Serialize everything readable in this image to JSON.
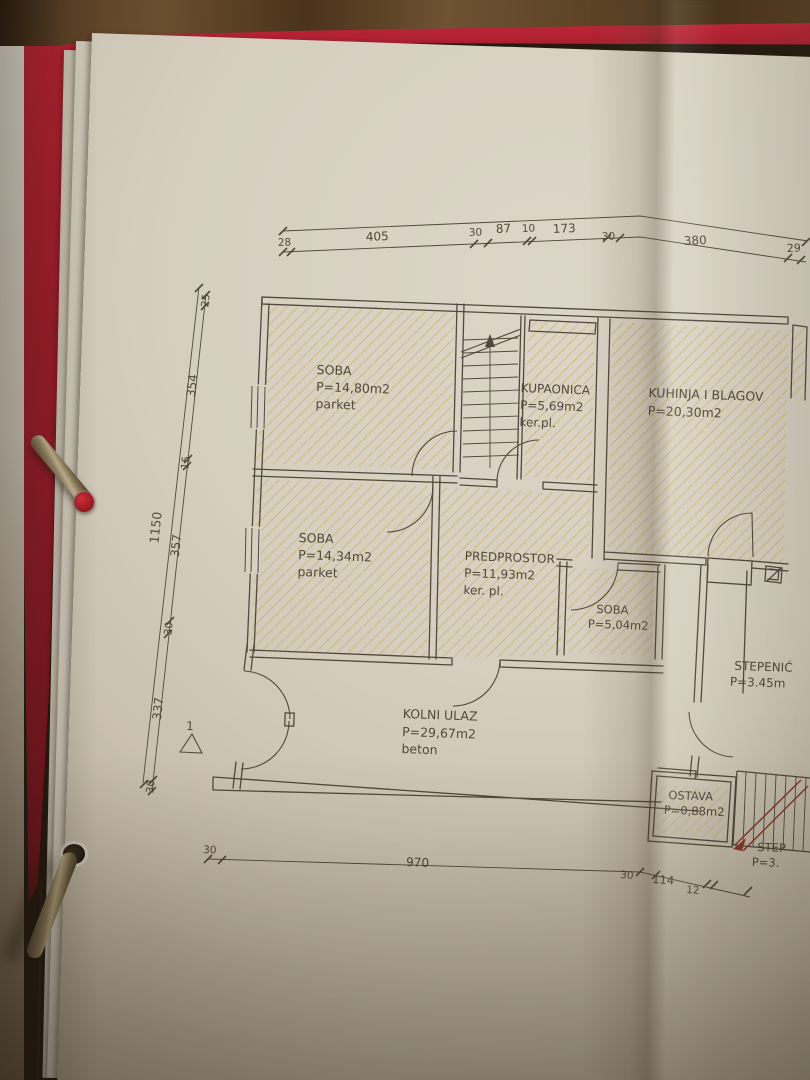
{
  "photo": {
    "surface": "wood-table",
    "binder_color": "#a91f2b",
    "paper_color": "#d6cfc0",
    "ink_color": "#4c4437",
    "hatch_color": "#bfab44",
    "stair_section_color": "#8a3a2c"
  },
  "plan": {
    "rooms": [
      {
        "name": "SOBA",
        "area": "P=14,80m2",
        "floor": "parket"
      },
      {
        "name": "KUPAONICA",
        "area": "P=5,69m2",
        "floor": "ker.pl."
      },
      {
        "name": "KUHINJA I BLAGOV",
        "area": "P=20,30m2",
        "floor": ""
      },
      {
        "name": "SOBA",
        "area": "P=14,34m2",
        "floor": "parket"
      },
      {
        "name": "PREDPROSTOR",
        "area": "P=11,93m2",
        "floor": "ker. pl."
      },
      {
        "name": "SOBA",
        "area": "P=5,04m2",
        "floor": ""
      },
      {
        "name": "STEPENIĆ",
        "area": "P=3.45m",
        "floor": ""
      },
      {
        "name": "KOLNI ULAZ",
        "area": "P=29,67m2",
        "floor": "beton"
      },
      {
        "name": "OSTAVA",
        "area": "P=0,88m2",
        "floor": ""
      },
      {
        "name": "STEP",
        "area": "P=3.",
        "floor": ""
      }
    ],
    "dimensions": {
      "top": [
        "28",
        "405",
        "30",
        "87",
        "10",
        "173",
        "30",
        "380",
        "29"
      ],
      "left": [
        "25",
        "354",
        "15",
        "357",
        "30",
        "337",
        "30"
      ],
      "left_overall": "1150",
      "bottom": [
        "30",
        "970",
        "30",
        "114",
        "12"
      ],
      "section_marker": "1"
    }
  }
}
